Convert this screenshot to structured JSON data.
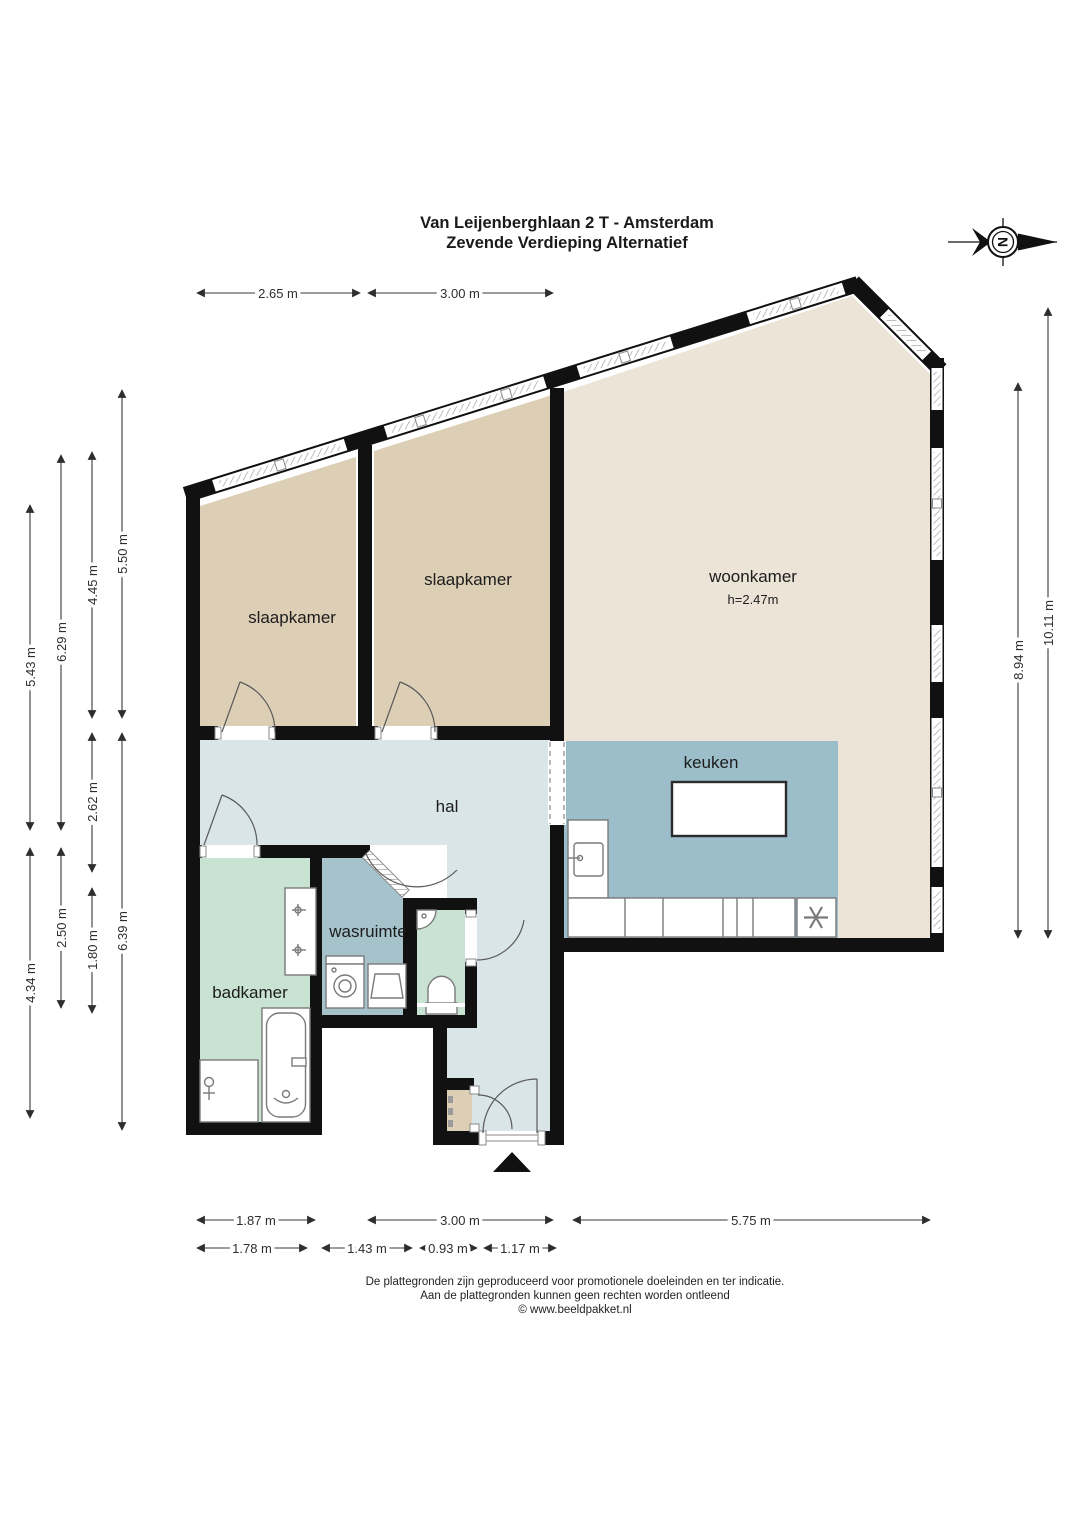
{
  "title": {
    "line1": "Van Leijenberghlaan 2 T - Amsterdam",
    "line2": "Zevende Verdieping Alternatief"
  },
  "compass": {
    "north_letter": "N"
  },
  "rooms": {
    "slaapkamer_left": "slaapkamer",
    "slaapkamer_middle": "slaapkamer",
    "woonkamer": "woonkamer",
    "woonkamer_ceiling_height": "h=2.47m",
    "keuken": "keuken",
    "hal": "hal",
    "wasruimte": "wasruimte",
    "badkamer": "badkamer"
  },
  "dimensions": {
    "top": [
      "2.65 m",
      "3.00 m"
    ],
    "left": [
      "5.43 m",
      "6.29 m",
      "4.45 m",
      "5.50 m",
      "2.62 m",
      "2.50 m",
      "1.80 m",
      "6.39 m",
      "4.34 m"
    ],
    "right": [
      "8.94 m",
      "10.11 m"
    ],
    "bottom_row1": [
      "1.87 m",
      "3.00 m",
      "5.75 m"
    ],
    "bottom_row2": [
      "1.78 m",
      "1.43 m",
      "0.93 m",
      "1.17 m"
    ]
  },
  "footer": {
    "line1": "De plattegronden zijn geproduceerd voor promotionele doeleinden en ter indicatie.",
    "line2": "Aan de plattegronden kunnen geen rechten worden ontleend",
    "line3": "© www.beeldpakket.nl"
  },
  "colors": {
    "wall": "#111111",
    "slaapkamer": "#dccfb5",
    "woonkamer": "#ece4d6",
    "keuken": "#9cbeca",
    "wasruimte": "#a6c3cc",
    "hal": "#d9e5e7",
    "badkamer": "#c9e3d2",
    "meterkast": "#dccfb5"
  }
}
